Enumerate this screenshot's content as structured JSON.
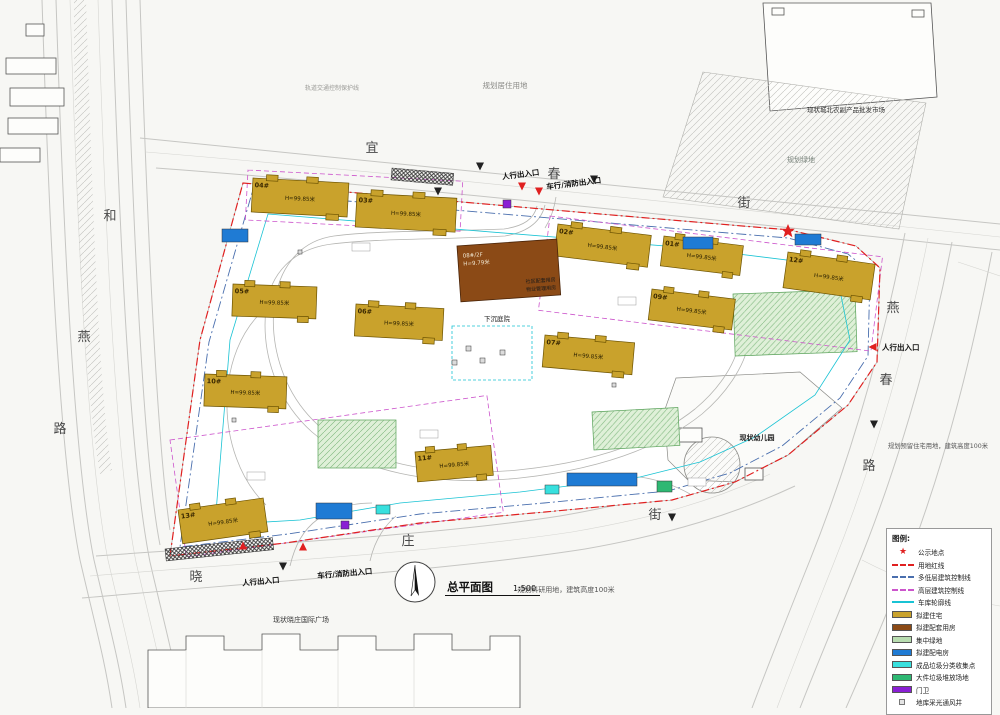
{
  "title": {
    "label": "总平面图",
    "scale": "1:500"
  },
  "colors": {
    "residential": "#C9A22C",
    "service": "#8B4A16",
    "green_space": "#CFE8C4",
    "power": "#1F7BD4",
    "recycle": "#38E0DE",
    "bulky": "#2EB873",
    "guard": "#8A1FD4",
    "vent": "#DCDCDC",
    "red_line": "#E02020",
    "mid_low_control": "#4A6FAE",
    "highrise_control": "#CC55CC",
    "garage_outline": "#19C3D4"
  },
  "legend": {
    "title": "图例:",
    "items": [
      {
        "sample": "star",
        "color": "#E02020",
        "label": "公示地点"
      },
      {
        "sample": "line",
        "color": "#E02020",
        "line_style": "dashed",
        "label": "用地红线"
      },
      {
        "sample": "line",
        "color": "#4A6FAE",
        "line_style": "dashed",
        "label": "多低层建筑控制线"
      },
      {
        "sample": "line",
        "color": "#CC55CC",
        "line_style": "dashed",
        "label": "高层建筑控制线"
      },
      {
        "sample": "line",
        "color": "#19C3D4",
        "line_style": "solid",
        "label": "车库轮廓线"
      },
      {
        "sample": "swatch",
        "color": "#C9A22C",
        "label": "拟建住宅"
      },
      {
        "sample": "swatch",
        "color": "#8B4A16",
        "label": "拟建配套用房"
      },
      {
        "sample": "swatch",
        "color": "#B8DDB0",
        "label": "集中绿地"
      },
      {
        "sample": "swatch",
        "color": "#1F7BD4",
        "label": "拟建配电房"
      },
      {
        "sample": "swatch",
        "color": "#38E0DE",
        "label": "成品垃圾分类收集点"
      },
      {
        "sample": "swatch",
        "color": "#2EB873",
        "label": "大件垃圾堆放场地"
      },
      {
        "sample": "swatch",
        "color": "#8A1FD4",
        "label": "门卫"
      },
      {
        "sample": "square",
        "color": "#E4E4E4",
        "label": "地库采光通风井"
      }
    ]
  },
  "streets": [
    {
      "name": "宜春街",
      "positions": [
        [
          372,
          152
        ],
        [
          554,
          178
        ],
        [
          744,
          207
        ]
      ]
    },
    {
      "name": "和燕路",
      "positions": [
        [
          110,
          220
        ],
        [
          84,
          341
        ],
        [
          60,
          433
        ]
      ]
    },
    {
      "name": "燕春路",
      "positions": [
        [
          893,
          312
        ],
        [
          886,
          384
        ],
        [
          869,
          470
        ]
      ]
    },
    {
      "name": "晓庄街",
      "positions": [
        [
          196,
          581
        ],
        [
          408,
          545
        ],
        [
          655,
          519
        ]
      ]
    }
  ],
  "labels": [
    {
      "name": "planned-residential-label",
      "text": "规划居住用地",
      "x": 505,
      "y": 88,
      "size": 7.5,
      "color": "#8a8a86"
    },
    {
      "name": "market-label",
      "text": "现状城北农副产品批发市场",
      "x": 846,
      "y": 112,
      "size": 6.5,
      "color": "#333"
    },
    {
      "name": "planned-green-label",
      "text": "规划绿地",
      "x": 801,
      "y": 162,
      "size": 7,
      "color": "#77827a"
    },
    {
      "name": "research-land-label",
      "text": "规划科研用地，建筑高度100米",
      "x": 566,
      "y": 592,
      "size": 7,
      "color": "#555"
    },
    {
      "name": "reserved-land-label",
      "text": "规划预留住宅用地，建筑高度100米",
      "x": 938,
      "y": 448,
      "size": 6.3,
      "color": "#555"
    },
    {
      "name": "plaza-label",
      "text": "现状晓庄国际广场",
      "x": 301,
      "y": 622,
      "size": 7,
      "color": "#333"
    },
    {
      "name": "kindergarten-label",
      "text": "现状幼儿园",
      "x": 757,
      "y": 440,
      "size": 7,
      "color": "#222",
      "bold": true
    },
    {
      "name": "sunken-courtyard-label",
      "text": "下沉庭院",
      "x": 497,
      "y": 321,
      "size": 6.5,
      "color": "#222"
    },
    {
      "name": "rail-protection-label",
      "text": "轨道交通控制保护线",
      "x": 332,
      "y": 90,
      "size": 6,
      "color": "#9a9a96"
    },
    {
      "name": "entrance-label",
      "text": "人行出入口",
      "x": 521,
      "y": 177,
      "size": 7.5,
      "color": "#111",
      "bold": true,
      "rot": -7
    },
    {
      "name": "entrance-label",
      "text": "车行/消防出入口",
      "x": 574,
      "y": 186,
      "size": 7.5,
      "color": "#111",
      "bold": true,
      "rot": -7
    },
    {
      "name": "entrance-label",
      "text": "人行出入口",
      "x": 261,
      "y": 584,
      "size": 7.5,
      "color": "#111",
      "bold": true,
      "rot": -5
    },
    {
      "name": "entrance-label",
      "text": "车行/消防出入口",
      "x": 345,
      "y": 576,
      "size": 7.5,
      "color": "#111",
      "bold": true,
      "rot": -5
    },
    {
      "name": "entrance-label",
      "text": "人行出入口",
      "x": 882,
      "y": 350,
      "size": 7.5,
      "color": "#111",
      "bold": true,
      "anchor": "start"
    }
  ],
  "residential_buildings": [
    {
      "num": "04#",
      "height": "H=99.85米",
      "x": 253,
      "y": 178,
      "w": 96,
      "h": 34,
      "rot": 3
    },
    {
      "num": "03#",
      "height": "H=99.85米",
      "x": 357,
      "y": 193,
      "w": 100,
      "h": 34,
      "rot": 3
    },
    {
      "num": "02#",
      "height": "H=99.85米",
      "x": 558,
      "y": 224,
      "w": 94,
      "h": 32,
      "rot": 7
    },
    {
      "num": "01#",
      "height": "H=99.85米",
      "x": 664,
      "y": 236,
      "w": 80,
      "h": 30,
      "rot": 7
    },
    {
      "num": "12#",
      "height": "H=99.85米",
      "x": 788,
      "y": 252,
      "w": 88,
      "h": 36,
      "rot": 8
    },
    {
      "num": "05#",
      "height": "H=99.85米",
      "x": 233,
      "y": 284,
      "w": 84,
      "h": 32,
      "rot": 2
    },
    {
      "num": "06#",
      "height": "H=99.85米",
      "x": 356,
      "y": 304,
      "w": 88,
      "h": 32,
      "rot": 3
    },
    {
      "num": "09#",
      "height": "H=99.85米",
      "x": 652,
      "y": 289,
      "w": 84,
      "h": 31,
      "rot": 7
    },
    {
      "num": "07#",
      "height": "H=99.85米",
      "x": 545,
      "y": 335,
      "w": 90,
      "h": 32,
      "rot": 5
    },
    {
      "num": "10#",
      "height": "H=99.85米",
      "x": 205,
      "y": 374,
      "w": 82,
      "h": 32,
      "rot": 2
    },
    {
      "num": "11#",
      "height": "H=99.85米",
      "x": 415,
      "y": 452,
      "w": 76,
      "h": 30,
      "rot": -5
    },
    {
      "num": "13#",
      "height": "H=99.85米",
      "x": 178,
      "y": 510,
      "w": 86,
      "h": 34,
      "rot": -8
    }
  ],
  "service_building": {
    "num": "08#/2F",
    "height": "H=9.79米",
    "lines": [
      "社区配套用房",
      "物业管理用房"
    ],
    "x": 457,
    "y": 246,
    "w": 100,
    "h": 56,
    "rot": -4
  },
  "facilities": [
    {
      "type": "power",
      "x": 222,
      "y": 229,
      "w": 26,
      "h": 13
    },
    {
      "type": "power",
      "x": 683,
      "y": 237,
      "w": 30,
      "h": 12
    },
    {
      "type": "power",
      "x": 795,
      "y": 234,
      "w": 26,
      "h": 11
    },
    {
      "type": "power",
      "x": 316,
      "y": 503,
      "w": 36,
      "h": 16
    },
    {
      "type": "power",
      "x": 567,
      "y": 473,
      "w": 70,
      "h": 13
    },
    {
      "type": "recycle",
      "x": 376,
      "y": 505,
      "w": 14,
      "h": 9
    },
    {
      "type": "recycle",
      "x": 545,
      "y": 485,
      "w": 14,
      "h": 9
    },
    {
      "type": "bulky",
      "x": 657,
      "y": 481,
      "w": 15,
      "h": 11
    },
    {
      "type": "guard",
      "x": 503,
      "y": 200,
      "w": 8,
      "h": 8
    },
    {
      "type": "guard",
      "x": 341,
      "y": 521,
      "w": 8,
      "h": 8
    },
    {
      "type": "vent",
      "x": 466,
      "y": 346,
      "w": 5,
      "h": 5
    },
    {
      "type": "vent",
      "x": 480,
      "y": 358,
      "w": 5,
      "h": 5
    },
    {
      "type": "vent",
      "x": 500,
      "y": 350,
      "w": 5,
      "h": 5
    },
    {
      "type": "vent",
      "x": 452,
      "y": 360,
      "w": 5,
      "h": 5
    },
    {
      "type": "vent",
      "x": 298,
      "y": 250,
      "w": 4,
      "h": 4
    },
    {
      "type": "vent",
      "x": 612,
      "y": 383,
      "w": 4,
      "h": 4
    },
    {
      "type": "vent",
      "x": 232,
      "y": 418,
      "w": 4,
      "h": 4
    }
  ],
  "markers": [
    {
      "kind": "star",
      "x": 788,
      "y": 231,
      "color": "#E02020"
    },
    {
      "kind": "tri",
      "x": 522,
      "y": 186,
      "rot": 180,
      "color": "#E02020"
    },
    {
      "kind": "tri",
      "x": 539,
      "y": 191,
      "rot": 180,
      "color": "#E02020"
    },
    {
      "kind": "tri",
      "x": 243,
      "y": 546,
      "rot": 0,
      "color": "#E02020"
    },
    {
      "kind": "tri",
      "x": 303,
      "y": 547,
      "rot": 0,
      "color": "#E02020"
    },
    {
      "kind": "tri",
      "x": 873,
      "y": 347,
      "rot": 270,
      "color": "#E02020"
    },
    {
      "kind": "tri",
      "x": 480,
      "y": 166,
      "rot": 180,
      "color": "#222"
    },
    {
      "kind": "tri",
      "x": 594,
      "y": 179,
      "rot": 180,
      "color": "#222"
    },
    {
      "kind": "tri",
      "x": 283,
      "y": 566,
      "rot": 180,
      "color": "#222"
    },
    {
      "kind": "tri",
      "x": 672,
      "y": 517,
      "rot": 180,
      "color": "#222"
    },
    {
      "kind": "tri",
      "x": 874,
      "y": 424,
      "rot": 180,
      "color": "#222"
    },
    {
      "kind": "tri",
      "x": 438,
      "y": 191,
      "rot": 180,
      "color": "#222"
    }
  ]
}
